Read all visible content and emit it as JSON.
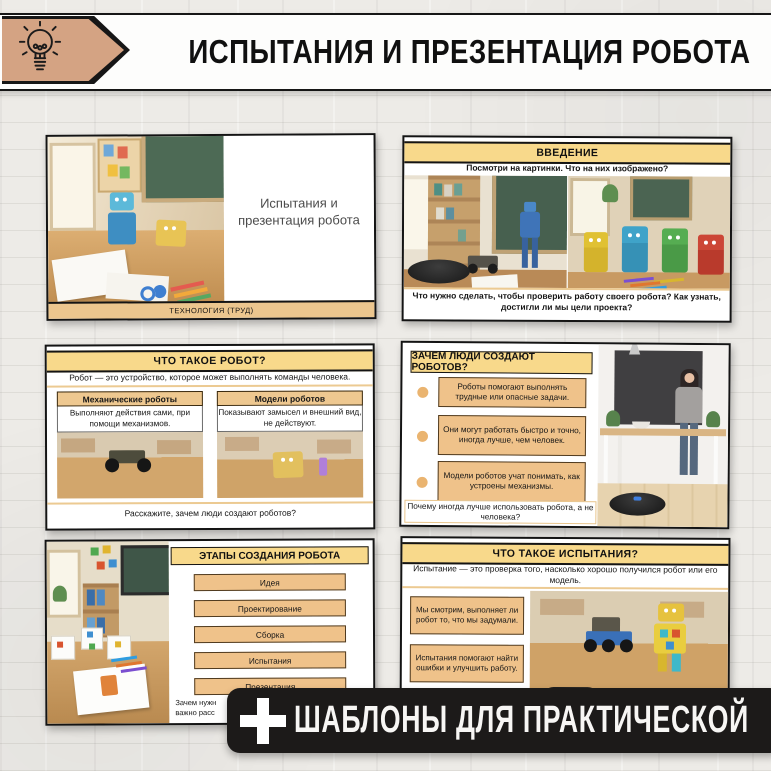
{
  "header": {
    "title": "ИСПЫТАНИЯ И ПРЕЗЕНТАЦИЯ РОБОТА",
    "icon": "lightbulb-icon",
    "pennant_color": "#d4a383"
  },
  "ribbon": {
    "icon": "plus-icon",
    "label": "ШАБЛОНЫ ДЛЯ ПРАКТИЧЕСКОЙ",
    "bg_color": "#1c1a19"
  },
  "colors": {
    "header_yellow": "#f8d98b",
    "box_tan": "#efc28a",
    "footer_tan": "#ecc68e"
  },
  "slides": {
    "title_slide": {
      "title": "Испытания и презентация робота",
      "subject_footer": "ТЕХНОЛОГИЯ (ТРУД)"
    },
    "intro": {
      "header": "ВВЕДЕНИЕ",
      "prompt": "Посмотри на картинки. Что на них изображено?",
      "question": "Что нужно сделать, чтобы проверить работу своего робота? Как узнать, достигли ли мы цели проекта?"
    },
    "what_is_robot": {
      "header": "ЧТО ТАКОЕ РОБОТ?",
      "definition": "Робот — это устройство, которое может выполнять команды человека.",
      "columns": [
        {
          "title": "Механические роботы",
          "text": "Выполняют действия сами, при помощи механизмов."
        },
        {
          "title": "Модели роботов",
          "text": "Показывают замысел и внешний вид, не действуют."
        }
      ],
      "question": "Расскажите, зачем люди создают роботов?"
    },
    "why_robots": {
      "header": "ЗАЧЕМ ЛЮДИ СОЗДАЮТ РОБОТОВ?",
      "bullets": [
        "Роботы помогают выполнять трудные или опасные задачи.",
        "Они могут работать быстро и точно, иногда лучше, чем человек.",
        "Модели роботов учат понимать, как устроены механизмы."
      ],
      "question": "Почему иногда лучше использовать робота, а не человека?"
    },
    "stages": {
      "header": "ЭТАПЫ СОЗДАНИЯ РОБОТА",
      "steps": [
        "Идея",
        "Проектирование",
        "Сборка",
        "Испытания",
        "Презентация"
      ],
      "question_line1": "Зачем нужн",
      "question_line2": "важно расс"
    },
    "what_are_tests": {
      "header": "ЧТО ТАКОЕ ИСПЫТАНИЯ?",
      "definition": "Испытание — это проверка того, насколько хорошо получился робот или его модель.",
      "boxes": [
        "Мы смотрим, выполняет ли робот то, что мы задумали.",
        "Испытания помогают найти ошибки и улучшить работу."
      ]
    }
  }
}
